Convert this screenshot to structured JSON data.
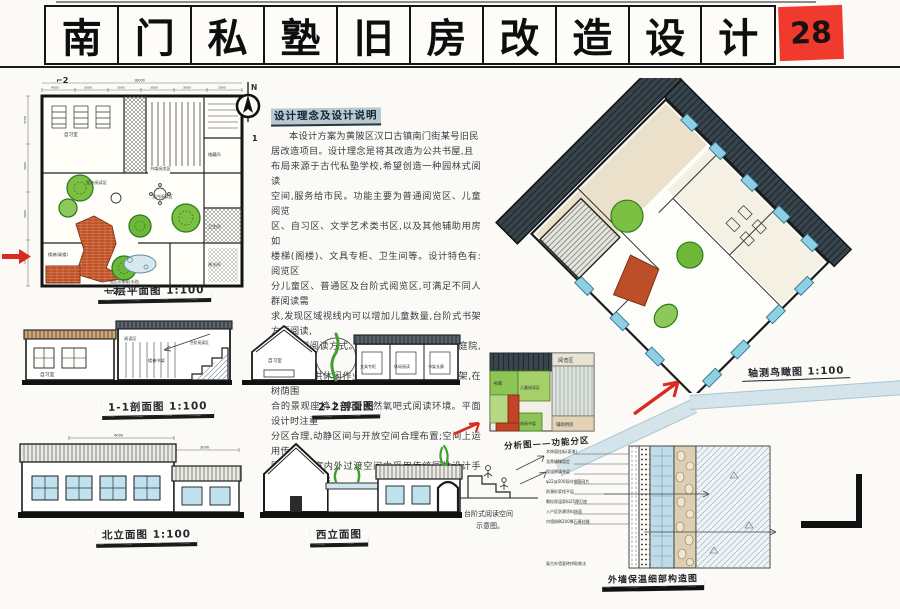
{
  "sheet": {
    "number": "28",
    "title_chars": [
      "南",
      "门",
      "私",
      "塾",
      "旧",
      "房",
      "改",
      "造",
      "设",
      "计"
    ]
  },
  "notes": {
    "heading": "设计理念及设计说明",
    "lines": [
      "本设计方案为黄陂区汉口古镇南门街某号旧民",
      "居改造项目。设计理念是将其改造为公共书屋,且",
      "布局来源于古代私塾学校,希望创造一种园林式阅读",
      "空间,服务给市民。功能主要为普通阅览区、儿童阅览",
      "区、自习区、文学艺术类书区,以及其他辅助用房如",
      "楼梯(阁楼)、文具专柜、卫生间等。设计特色有:阅览区",
      "分儿童区、普通区及台阶式阅览区,可满足不同人群阅读需",
      "求,发现区域视线内可以增加儿童数量,台阶式书架方便阅读,",
      "营造新型阅读方式。庭院里种植五谷树,浓荫庭院,设置2处",
      "休闲区,可供休闲作业。室外设有量身定制书架,在树荫围",
      "合的景观座椅上,享受天然氧吧式阅读环境。平面设计时注重",
      "分区合理,动静区间与开放空间合理布置;空间上运用传统",
      "园林意境,室内外过渡空间中采用传统园林设计手法:对景、框景、",
      "借景相结合,整个书屋焕发出旧建筑新的活力。"
    ]
  },
  "plan": {
    "caption": "一层平面图 1:100",
    "north": "N",
    "total_dim": "18000",
    "top_dims": [
      "4000",
      "3000",
      "3000",
      "3000",
      "3000",
      "2000"
    ],
    "left_dims": [
      "4500",
      "3000",
      "3000",
      "1500"
    ],
    "rooms": [
      "自习室",
      "书架阅览区",
      "室外阅读区",
      "室内阅读区",
      "楼梯(阁楼)",
      "假山水景观(水池)",
      "储藏间",
      "卫生间",
      "茶水间"
    ],
    "cut_marks": [
      "⌐2",
      "∟2",
      "1"
    ]
  },
  "axon": {
    "caption": "轴测鸟瞰图 1:100"
  },
  "sections": {
    "s11": {
      "caption": "1-1剖面图 1:100",
      "labels": [
        "自习室",
        "阅读区",
        "楼梯书架",
        "台阶阅读区"
      ]
    },
    "s22": {
      "caption": "2-2剖面图",
      "labels": [
        "自习室",
        "文具专柜",
        "休闲阅读",
        "书架长廊"
      ]
    }
  },
  "elevations": {
    "north": {
      "caption": "北立面图 1:100",
      "dims": [
        "4000",
        "3000"
      ]
    },
    "west": {
      "caption": "西立面图"
    }
  },
  "zoning": {
    "caption": "分析图——功能分区",
    "labels": [
      "阅览区",
      "书库",
      "儿童阅读区",
      "休闲书架",
      "辅助用房"
    ]
  },
  "detail": {
    "caption": "外墙保温细部构造图",
    "sketch_label_1": "台阶式阅读空间",
    "sketch_label_2": "示意图。",
    "annotations": [
      "木饰面挂板(面漆)",
      "龙骨横撑固定",
      "保温棉填充层",
      "φ22@500双向钢筋网片",
      "防潮砂浆找平层",
      "颗粒保温浆料25厚打底",
      "入户区防潮涂料饰面",
      "内墙粉刷200厚石膏封缝",
      "复古外墙瓷砖拼贴做法"
    ]
  },
  "colors": {
    "badge_red": "#ef3a2d",
    "arrow_red": "#d92b1f",
    "tree_green": "#7cc043",
    "brick_red": "#c05227",
    "window_blue": "#bfe2ee",
    "roof_dark": "#39454d",
    "paper": "#fbfaf6",
    "ink": "#141414"
  }
}
